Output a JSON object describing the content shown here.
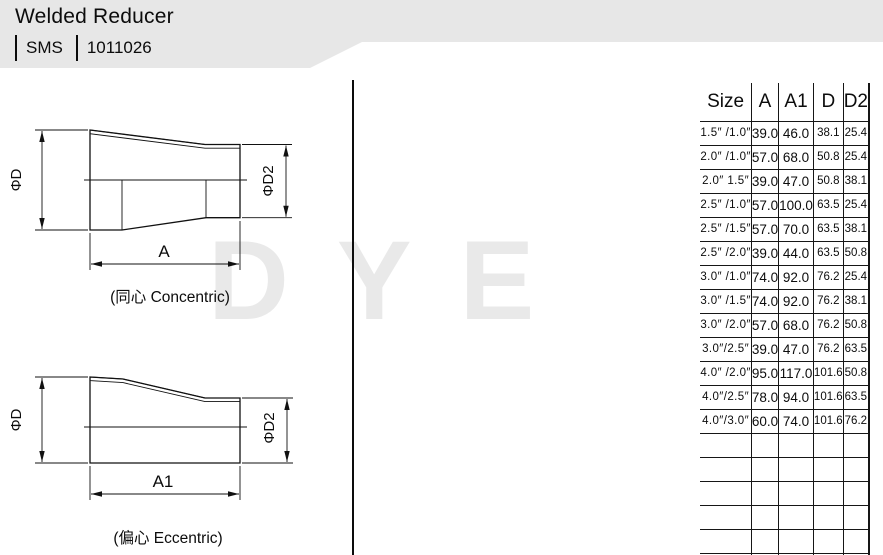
{
  "header": {
    "title": "Welded Reducer",
    "standard": "SMS",
    "code": "1011026"
  },
  "watermark": {
    "text": "DYE"
  },
  "drawings": {
    "concentric": {
      "caption": "(同心 Concentric)",
      "phi_d_label": "ΦD",
      "phi_d2_label": "ΦD2",
      "length_label": "A"
    },
    "eccentric": {
      "caption": "(偏心 Eccentric)",
      "phi_d_label": "ΦD",
      "phi_d2_label": "ΦD2",
      "length_label": "A1"
    }
  },
  "table": {
    "columns": [
      "Size",
      "A",
      "A1",
      "D",
      "D2"
    ],
    "rows": [
      [
        "1.5″ /1.0″",
        "39.0",
        "46.0",
        "38.1",
        "25.4"
      ],
      [
        "2.0″ /1.0″",
        "57.0",
        "68.0",
        "50.8",
        "25.4"
      ],
      [
        "2.0″  1.5″",
        "39.0",
        "47.0",
        "50.8",
        "38.1"
      ],
      [
        "2.5″ /1.0″",
        "57.0",
        "100.0",
        "63.5",
        "25.4"
      ],
      [
        "2.5″ /1.5″",
        "57.0",
        "70.0",
        "63.5",
        "38.1"
      ],
      [
        "2.5″ /2.0″",
        "39.0",
        "44.0",
        "63.5",
        "50.8"
      ],
      [
        "3.0″ /1.0″",
        "74.0",
        "92.0",
        "76.2",
        "25.4"
      ],
      [
        "3.0″ /1.5″",
        "74.0",
        "92.0",
        "76.2",
        "38.1"
      ],
      [
        "3.0″ /2.0″",
        "57.0",
        "68.0",
        "76.2",
        "50.8"
      ],
      [
        "3.0″/2.5″",
        "39.0",
        "47.0",
        "76.2",
        "63.5"
      ],
      [
        "4.0″ /2.0″",
        "95.0",
        "117.0",
        "101.6",
        "50.8"
      ],
      [
        "4.0″/2.5″",
        "78.0",
        "94.0",
        "101.6",
        "63.5"
      ],
      [
        "4.0″/3.0″",
        "60.0",
        "74.0",
        "101.6",
        "76.2"
      ]
    ]
  },
  "colors": {
    "banner": "#e7e7e7",
    "line": "#161616",
    "watermark": "#e9e9e9"
  }
}
